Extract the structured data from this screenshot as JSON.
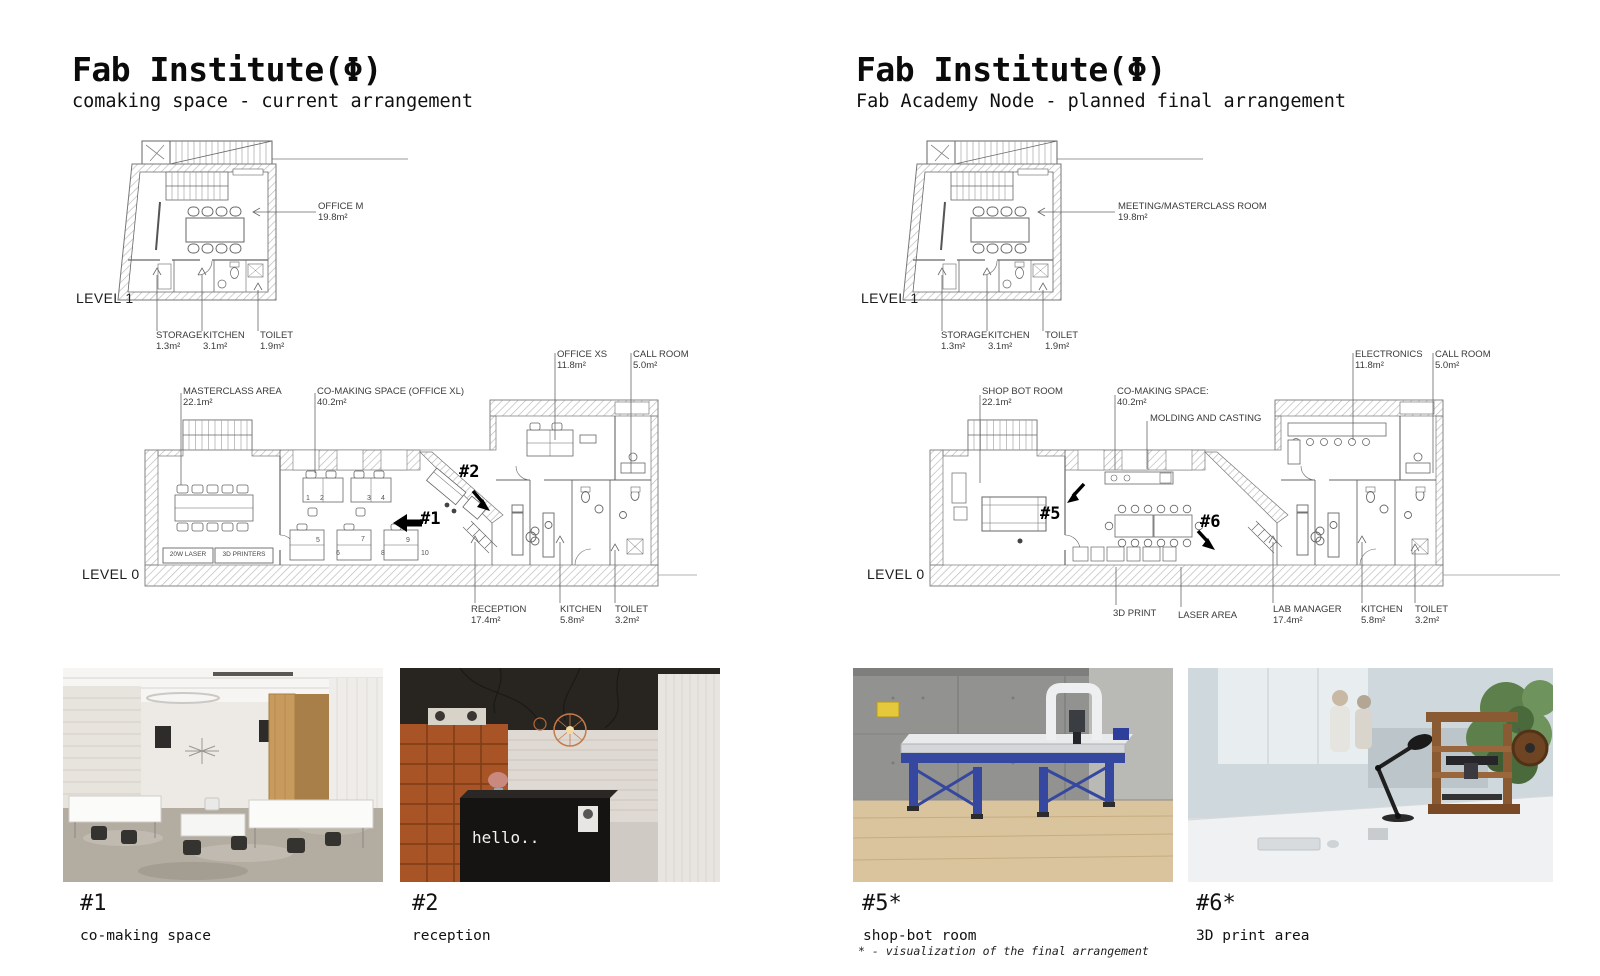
{
  "columns": {
    "left": {
      "title": "Fab Institute(Φ)",
      "subtitle": "comaking space - current arrangement",
      "level1": {
        "label": "LEVEL 1",
        "office": {
          "name": "OFFICE M",
          "area": "19.8m²"
        },
        "storage": {
          "name": "STORAGE",
          "area": "1.3m²"
        },
        "kitchen": {
          "name": "KITCHEN",
          "area": "3.1m²"
        },
        "toilet": {
          "name": "TOILET",
          "area": "1.9m²"
        }
      },
      "level0": {
        "label": "LEVEL 0",
        "masterclass": {
          "name": "MASTERCLASS AREA",
          "area": "22.1m²"
        },
        "comaking": {
          "name": "CO-MAKING SPACE (OFFICE XL)",
          "area": "40.2m²"
        },
        "office_xs": {
          "name": "OFFICE XS",
          "area": "11.8m²"
        },
        "call_room": {
          "name": "CALL ROOM",
          "area": "5.0m²"
        },
        "reception": {
          "name": "RECEPTION",
          "area": "17.4m²"
        },
        "kitchen": {
          "name": "KITCHEN",
          "area": "5.8m²"
        },
        "toilet": {
          "name": "TOILET",
          "area": "3.2m²"
        },
        "laser_label": "20W LASER",
        "printers_label": "3D PRINTERS",
        "marker1": "#1",
        "marker2": "#2",
        "desks": [
          "1",
          "2",
          "3",
          "4",
          "5",
          "6",
          "7",
          "8",
          "9",
          "10"
        ]
      },
      "photos": [
        {
          "marker": "#1",
          "caption": "co-making space"
        },
        {
          "marker": "#2",
          "caption": "reception",
          "sign_text": "hello.."
        }
      ]
    },
    "right": {
      "title": "Fab Institute(Φ)",
      "subtitle": "Fab Academy Node - planned final arrangement",
      "level1": {
        "label": "LEVEL 1",
        "meeting": {
          "name": "MEETING/MASTERCLASS ROOM",
          "area": "19.8m²"
        },
        "storage": {
          "name": "STORAGE",
          "area": "1.3m²"
        },
        "kitchen": {
          "name": "KITCHEN",
          "area": "3.1m²"
        },
        "toilet": {
          "name": "TOILET",
          "area": "1.9m²"
        }
      },
      "level0": {
        "label": "LEVEL 0",
        "shopbot": {
          "name": "SHOP BOT ROOM",
          "area": "22.1m²"
        },
        "comaking": {
          "name": "CO-MAKING SPACE:",
          "area": "40.2m²"
        },
        "molding": "MOLDING AND CASTING",
        "electronics": {
          "name": "ELECTRONICS",
          "area": "11.8m²"
        },
        "call_room": {
          "name": "CALL ROOM",
          "area": "5.0m²"
        },
        "print3d": "3D PRINT",
        "laser_area": "LASER AREA",
        "lab_manager": {
          "name": "LAB MANAGER",
          "area": "17.4m²"
        },
        "kitchen": {
          "name": "KITCHEN",
          "area": "5.8m²"
        },
        "toilet": {
          "name": "TOILET",
          "area": "3.2m²"
        },
        "marker5": "#5",
        "marker6": "#6"
      },
      "photos": [
        {
          "marker": "#5*",
          "caption": "shop-bot room"
        },
        {
          "marker": "#6*",
          "caption": "3D print area"
        }
      ],
      "footnote": "* - visualization of the final arrangement"
    }
  }
}
